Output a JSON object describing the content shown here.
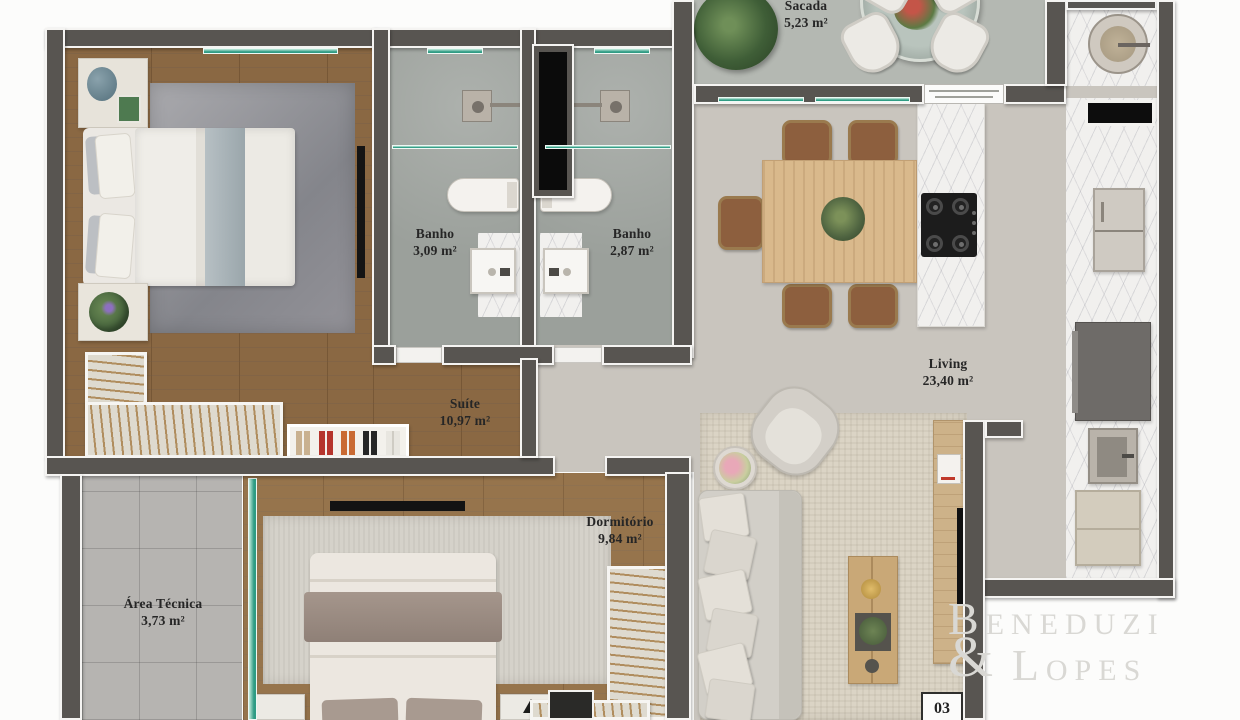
{
  "brand": {
    "line1": "Beneduzi",
    "amp": "&",
    "line2": "Lopes"
  },
  "unit_number": "03",
  "rooms": [
    {
      "id": "sacada",
      "name": "Sacada",
      "area": "5,23 m²"
    },
    {
      "id": "banho1",
      "name": "Banho",
      "area": "3,09 m²"
    },
    {
      "id": "banho2",
      "name": "Banho",
      "area": "2,87 m²"
    },
    {
      "id": "suite",
      "name": "Suíte",
      "area": "10,97 m²"
    },
    {
      "id": "living",
      "name": "Living",
      "area": "23,40 m²"
    },
    {
      "id": "dormitorio",
      "name": "Dormitório",
      "area": "9,84 m²"
    },
    {
      "id": "area_tecnica",
      "name": "Área Técnica",
      "area": "3,73 m²"
    }
  ],
  "colors": {
    "wall": "#585551",
    "wall_trim": "#f5f4f2",
    "wood_floor": "#8a6843",
    "wood_floor_light": "#96744c",
    "bath_floor": "#9ba09b",
    "tile_floor": "#b6b4b1",
    "main_floor": "#c9c5be",
    "balcony_floor": "#b4b8b2",
    "marble": "#f1f0ee",
    "glass_accent": "#2f9c84",
    "shaft": "#0b0b0b",
    "rug_gray": "#97989d",
    "rug_beige": "#dbd4c5",
    "rug_light": "#d5d2ca",
    "chair_brown": "#8d5f3e",
    "table_wood": "#d9b98c",
    "console_wood": "#cdb289",
    "label_text": "#262626",
    "logo_text": "#d9d8d4"
  }
}
